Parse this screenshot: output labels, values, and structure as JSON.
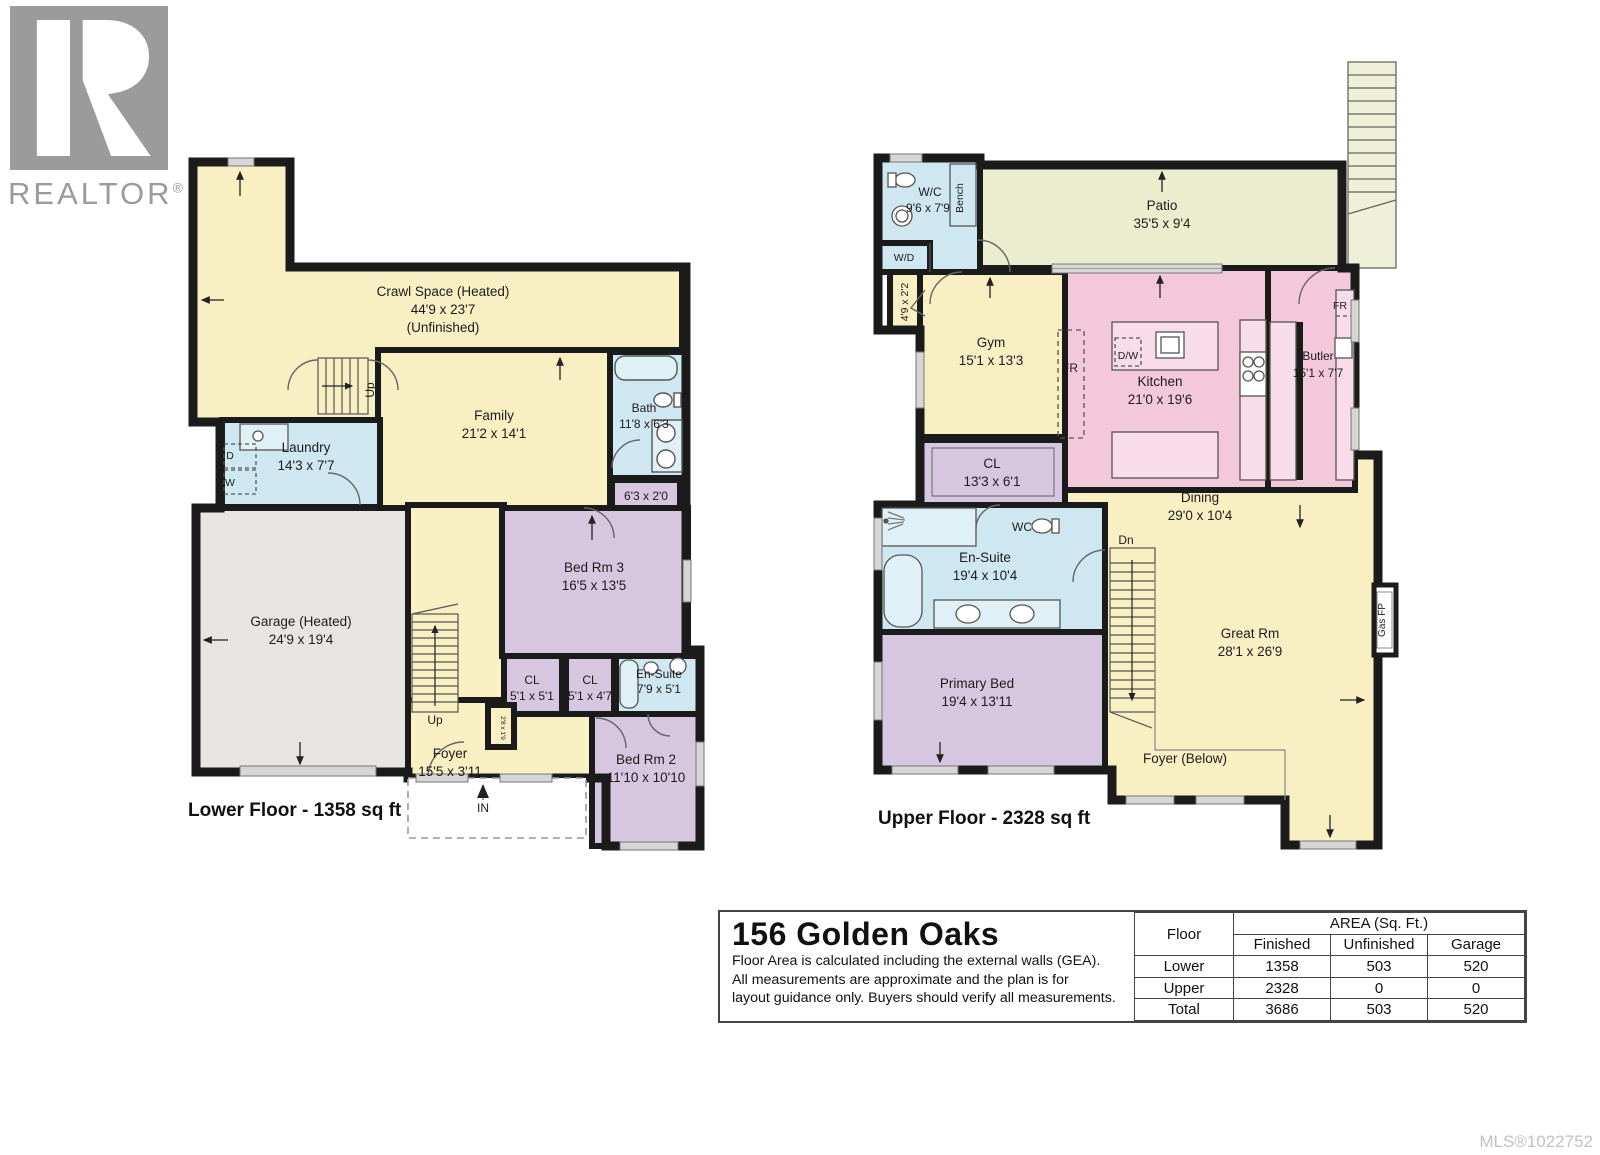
{
  "branding": {
    "logo_letter": "R",
    "logo_text": "REALTOR",
    "logo_reg": "®"
  },
  "colors": {
    "yellow": "#f8efc3",
    "blue": "#cfe7f0",
    "purple": "#d6c6df",
    "pink": "#f3c8da",
    "green": "#eaeecf",
    "garage_gray": "#e7e5e2",
    "wall": "#1b1b1b",
    "stair_pale": "#eef0d8"
  },
  "lower_floor": {
    "caption": "Lower Floor - 1358 sq ft",
    "rooms": {
      "crawl_space": {
        "name": "Crawl Space (Heated)",
        "dims": "44'9 x 23'7",
        "note": "(Unfinished)"
      },
      "family": {
        "name": "Family",
        "dims": "21'2 x 14'1"
      },
      "laundry": {
        "name": "Laundry",
        "dims": "14'3 x 7'7"
      },
      "bath": {
        "name": "Bath",
        "dims": "11'8 x 6'3"
      },
      "hall_closet": {
        "dims": "6'3 x 2'0"
      },
      "garage": {
        "name": "Garage (Heated)",
        "dims": "24'9 x 19'4"
      },
      "bed3": {
        "name": "Bed Rm 3",
        "dims": "16'5 x 13'5"
      },
      "closet1": {
        "name": "CL",
        "dims": "5'1 x 5'1"
      },
      "closet2": {
        "name": "CL",
        "dims": "5'1 x 4'7"
      },
      "ensuite": {
        "name": "En-Suite",
        "dims": "7'9 x 5'1"
      },
      "bed2": {
        "name": "Bed Rm 2",
        "dims": "11'10 x 10'10"
      },
      "foyer": {
        "name": "Foyer",
        "dims": "15'5 x 3'11"
      },
      "nook": {
        "dims": "2'8 x 1'9"
      }
    },
    "annotations": {
      "up1": "Up",
      "up2": "Up",
      "entry": "IN",
      "dryer": "D",
      "washer": "W"
    }
  },
  "upper_floor": {
    "caption": "Upper Floor - 2328 sq ft",
    "rooms": {
      "wc": {
        "name": "W/C",
        "dims": "9'6 x 7'9"
      },
      "patio": {
        "name": "Patio",
        "dims": "35'5 x 9'4"
      },
      "gym": {
        "name": "Gym",
        "dims": "15'1 x 13'3"
      },
      "kitchen": {
        "name": "Kitchen",
        "dims": "21'0 x 19'6"
      },
      "butler": {
        "name": "Butler",
        "dims": "15'1 x 7'7"
      },
      "closet": {
        "name": "CL",
        "dims": "13'3 x 6'1"
      },
      "wc2": {
        "name": "WC"
      },
      "ensuite": {
        "name": "En-Suite",
        "dims": "19'4 x 10'4"
      },
      "primary_bed": {
        "name": "Primary Bed",
        "dims": "19'4 x 13'11"
      },
      "dining": {
        "name": "Dining",
        "dims": "29'0 x 10'4"
      },
      "great_room": {
        "name": "Great Rm",
        "dims": "28'1 x 26'9"
      },
      "foyer_below": {
        "name": "Foyer (Below)"
      },
      "closet_small": {
        "dims": "4'9 x 2'2"
      }
    },
    "annotations": {
      "bench": "Bench",
      "wd": "W/D",
      "fridge1": "FR",
      "fridge2": "FR",
      "dishwasher": "D/W",
      "gas_fireplace": "Gas FP",
      "down": "Dn"
    }
  },
  "info": {
    "title": "156 Golden Oaks",
    "line1": "Floor Area is calculated including the external walls (GEA).",
    "line2": "All measurements are approximate and the plan is for",
    "line3": "layout guidance only. Buyers should verify all measurements.",
    "table": {
      "floor_header": "Floor",
      "area_header": "AREA (Sq. Ft.)",
      "col_finished": "Finished",
      "col_unfinished": "Unfinished",
      "col_garage": "Garage",
      "rows": [
        {
          "floor": "Lower",
          "finished": "1358",
          "unfinished": "503",
          "garage": "520"
        },
        {
          "floor": "Upper",
          "finished": "2328",
          "unfinished": "0",
          "garage": "0"
        },
        {
          "floor": "Total",
          "finished": "3686",
          "unfinished": "503",
          "garage": "520"
        }
      ]
    }
  },
  "footer": {
    "mls": "MLS®1022752"
  }
}
